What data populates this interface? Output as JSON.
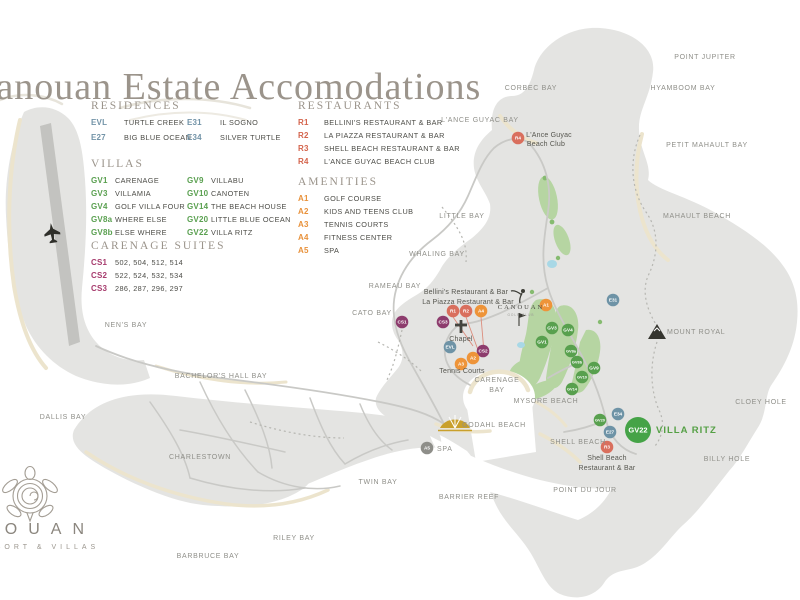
{
  "title": "Canouan Estate Accomodations",
  "logo": {
    "name": "CANOUAN",
    "tagline": "RESORT & VILLAS"
  },
  "colors": {
    "residence": "#6e93a6",
    "villa": "#58a04e",
    "villa_big": "#45a347",
    "suite": "#8d3c6d",
    "restaurant": "#d96f5d",
    "amenity": "#ee9439",
    "amenity_alt": "#8e8e89",
    "legend_residence": "#7293a7",
    "legend_villa": "#5aa050",
    "legend_suite": "#a63b6d",
    "legend_restaurant": "#d4644c",
    "legend_amenity": "#e8913a",
    "villa_ritz_green": "#55a045"
  },
  "legend": {
    "sections": [
      {
        "id": "residences",
        "heading": "RESIDENCES",
        "color_key": "legend_residence",
        "columns": [
          [
            {
              "code": "EVL",
              "name": "TURTLE CREEK"
            },
            {
              "code": "E27",
              "name": "BIG BLUE OCEAN"
            }
          ],
          [
            {
              "code": "E31",
              "name": "IL SOGNO"
            },
            {
              "code": "E34",
              "name": "SILVER TURTLE"
            }
          ]
        ]
      },
      {
        "id": "villas",
        "heading": "VILLAS",
        "color_key": "legend_villa",
        "columns": [
          [
            {
              "code": "GV1",
              "name": "CARENAGE"
            },
            {
              "code": "GV3",
              "name": "VILLAMIA"
            },
            {
              "code": "GV4",
              "name": "GOLF VILLA FOUR"
            },
            {
              "code": "GV8a",
              "name": "WHERE ELSE"
            },
            {
              "code": "GV8b",
              "name": "ELSE WHERE"
            }
          ],
          [
            {
              "code": "GV9",
              "name": "VILLABU"
            },
            {
              "code": "GV10",
              "name": "CANOTEN"
            },
            {
              "code": "GV14",
              "name": "THE BEACH HOUSE"
            },
            {
              "code": "GV20",
              "name": "LITTLE BLUE OCEAN"
            },
            {
              "code": "GV22",
              "name": "VILLA RITZ"
            }
          ]
        ]
      },
      {
        "id": "carenage_suites",
        "heading": "CARENAGE SUITES",
        "color_key": "legend_suite",
        "columns": [
          [
            {
              "code": "CS1",
              "name": "502, 504, 512, 514"
            },
            {
              "code": "CS2",
              "name": "522, 524, 532, 534"
            },
            {
              "code": "CS3",
              "name": "286, 287, 296, 297"
            }
          ]
        ]
      },
      {
        "id": "restaurants",
        "heading": "RESTAURANTS",
        "color_key": "legend_restaurant",
        "columns": [
          [
            {
              "code": "R1",
              "name": "BELLINI'S RESTAURANT & BAR"
            },
            {
              "code": "R2",
              "name": "LA PIAZZA  RESTAURANT & BAR"
            },
            {
              "code": "R3",
              "name": "SHELL BEACH RESTAURANT & BAR"
            },
            {
              "code": "R4",
              "name": "L'ANCE GUYAC BEACH CLUB"
            }
          ]
        ]
      },
      {
        "id": "amenities",
        "heading": "AMENITIES",
        "color_key": "legend_amenity",
        "columns": [
          [
            {
              "code": "A1",
              "name": "GOLF COURSE"
            },
            {
              "code": "A2",
              "name": "KIDS AND TEENS CLUB"
            },
            {
              "code": "A3",
              "name": "TENNIS COURTS"
            },
            {
              "code": "A4",
              "name": "FITNESS CENTER"
            },
            {
              "code": "A5",
              "name": "SPA"
            }
          ]
        ]
      }
    ]
  },
  "map": {
    "golf_logo": {
      "name": "CANOUAN",
      "sub": "GOLF CLUB"
    },
    "markers": [
      {
        "id": "R4",
        "x": 518,
        "y": 138,
        "kind": "restaurant"
      },
      {
        "id": "E31",
        "x": 613,
        "y": 300,
        "kind": "residence"
      },
      {
        "id": "A1",
        "x": 546,
        "y": 305,
        "kind": "amenity"
      },
      {
        "id": "R1",
        "x": 453,
        "y": 311,
        "kind": "restaurant"
      },
      {
        "id": "R2",
        "x": 466,
        "y": 311,
        "kind": "restaurant"
      },
      {
        "id": "A4",
        "x": 481,
        "y": 311,
        "kind": "amenity"
      },
      {
        "id": "CS1",
        "x": 402,
        "y": 322,
        "kind": "suite"
      },
      {
        "id": "CS3",
        "x": 443,
        "y": 322,
        "kind": "suite"
      },
      {
        "id": "GV3",
        "x": 552,
        "y": 328,
        "kind": "villa"
      },
      {
        "id": "GV4",
        "x": 568,
        "y": 330,
        "kind": "villa"
      },
      {
        "id": "GV1",
        "x": 542,
        "y": 342,
        "kind": "villa"
      },
      {
        "id": "EVL",
        "x": 450,
        "y": 347,
        "kind": "residence"
      },
      {
        "id": "CS2",
        "x": 483,
        "y": 351,
        "kind": "suite"
      },
      {
        "id": "GV8a",
        "x": 571,
        "y": 351,
        "kind": "villa"
      },
      {
        "id": "A2",
        "x": 473,
        "y": 358,
        "kind": "amenity"
      },
      {
        "id": "GV8b",
        "x": 577,
        "y": 362,
        "kind": "villa"
      },
      {
        "id": "A3",
        "x": 461,
        "y": 364,
        "kind": "amenity"
      },
      {
        "id": "GV9",
        "x": 594,
        "y": 368,
        "kind": "villa"
      },
      {
        "id": "GV10",
        "x": 582,
        "y": 377,
        "kind": "villa"
      },
      {
        "id": "GV14",
        "x": 572,
        "y": 389,
        "kind": "villa"
      },
      {
        "id": "E34",
        "x": 618,
        "y": 414,
        "kind": "residence"
      },
      {
        "id": "GV20",
        "x": 600,
        "y": 420,
        "kind": "villa"
      },
      {
        "id": "E27",
        "x": 610,
        "y": 432,
        "kind": "residence"
      },
      {
        "id": "GV22",
        "x": 638,
        "y": 430,
        "kind": "villa_big",
        "size": 13
      },
      {
        "id": "R3",
        "x": 607,
        "y": 447,
        "kind": "restaurant"
      },
      {
        "id": "A5",
        "x": 427,
        "y": 448,
        "kind": "amenity_alt"
      }
    ],
    "labels": [
      {
        "t": "POINT JUPITER",
        "x": 705,
        "y": 59,
        "s": "p"
      },
      {
        "t": "CORBEC BAY",
        "x": 531,
        "y": 90,
        "s": "p"
      },
      {
        "t": "HYAMBOOM BAY",
        "x": 683,
        "y": 90,
        "s": "p"
      },
      {
        "t": "L'ANCE GUYAC BAY",
        "x": 480,
        "y": 122,
        "s": "p"
      },
      {
        "t": "L'Ance Guyac",
        "x": 549,
        "y": 137,
        "s": "d"
      },
      {
        "t": "Beach Club",
        "x": 546,
        "y": 146,
        "s": "d"
      },
      {
        "t": "PETIT MAHAULT BAY",
        "x": 707,
        "y": 147,
        "s": "p"
      },
      {
        "t": "LITTLE BAY",
        "x": 462,
        "y": 218,
        "s": "p"
      },
      {
        "t": "MAHAULT BEACH",
        "x": 697,
        "y": 218,
        "s": "p"
      },
      {
        "t": "WHALING BAY",
        "x": 437,
        "y": 256,
        "s": "p"
      },
      {
        "t": "RAMEAU BAY",
        "x": 395,
        "y": 288,
        "s": "p"
      },
      {
        "t": "Bellini's Restaurant & Bar",
        "x": 466,
        "y": 294,
        "s": "d"
      },
      {
        "t": "La Piazza Restaurant & Bar",
        "x": 468,
        "y": 304,
        "s": "d"
      },
      {
        "t": "CATO BAY",
        "x": 372,
        "y": 315,
        "s": "p"
      },
      {
        "t": "NEN'S BAY",
        "x": 126,
        "y": 327,
        "s": "p"
      },
      {
        "t": "MOUNT ROYAL",
        "x": 667,
        "y": 334,
        "s": "p",
        "a": "s"
      },
      {
        "t": "Chapel",
        "x": 461,
        "y": 341,
        "s": "d"
      },
      {
        "t": "Tennis Courts",
        "x": 462,
        "y": 373,
        "s": "d"
      },
      {
        "t": "BACHELOR'S HALL BAY",
        "x": 221,
        "y": 378,
        "s": "p"
      },
      {
        "t": "CARENAGE",
        "x": 497,
        "y": 382,
        "s": "p"
      },
      {
        "t": "BAY",
        "x": 497,
        "y": 392,
        "s": "p"
      },
      {
        "t": "CLOEY HOLE",
        "x": 761,
        "y": 404,
        "s": "p"
      },
      {
        "t": "MYSORE BEACH",
        "x": 546,
        "y": 403,
        "s": "p"
      },
      {
        "t": "DALLIS BAY",
        "x": 63,
        "y": 419,
        "s": "p"
      },
      {
        "t": "GODAHL BEACH",
        "x": 494,
        "y": 427,
        "s": "p"
      },
      {
        "t": "VILLA RITZ",
        "x": 656,
        "y": 433,
        "s": "hl",
        "a": "s"
      },
      {
        "t": "SHELL BEACH",
        "x": 578,
        "y": 444,
        "s": "p"
      },
      {
        "t": "SPA",
        "x": 437,
        "y": 451,
        "s": "p",
        "a": "s"
      },
      {
        "t": "CHARLESTOWN",
        "x": 200,
        "y": 459,
        "s": "p"
      },
      {
        "t": "BILLY HOLE",
        "x": 727,
        "y": 461,
        "s": "p"
      },
      {
        "t": "Shell Beach",
        "x": 607,
        "y": 460,
        "s": "d"
      },
      {
        "t": "Restaurant & Bar",
        "x": 607,
        "y": 470,
        "s": "d"
      },
      {
        "t": "TWIN BAY",
        "x": 378,
        "y": 484,
        "s": "p"
      },
      {
        "t": "POINT DU JOUR",
        "x": 585,
        "y": 492,
        "s": "p"
      },
      {
        "t": "BARRIER REEF",
        "x": 469,
        "y": 499,
        "s": "p"
      },
      {
        "t": "RILEY BAY",
        "x": 294,
        "y": 540,
        "s": "p"
      },
      {
        "t": "BARBRUCE BAY",
        "x": 208,
        "y": 558,
        "s": "p"
      }
    ]
  }
}
